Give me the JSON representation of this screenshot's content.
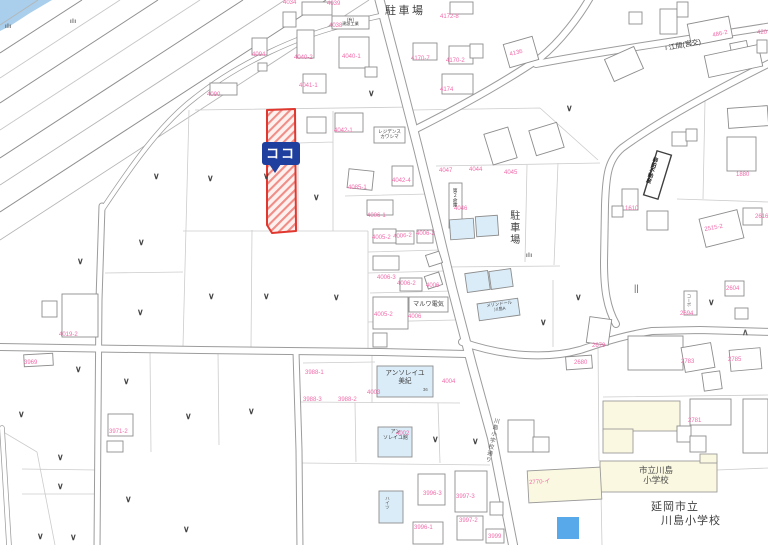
{
  "map": {
    "highlight": {
      "marker_label": "ココ",
      "parcel_color": "#e0372f",
      "marker_color": "#1e3f9e"
    },
    "place_labels": [
      {
        "name": "parking-label-top",
        "lines": [
          "駐車場"
        ],
        "x": 385,
        "y": 5,
        "size": 11,
        "ls": 2.5,
        "color": "#3d3d3d"
      },
      {
        "name": "parking-label-east",
        "lines": [
          "駐車場"
        ],
        "x": 507,
        "y": 210,
        "size": 10,
        "ls": 2,
        "vertical": true,
        "color": "#3d3d3d"
      },
      {
        "name": "maruwa-denki-label",
        "lines": [
          "マルワ電気"
        ],
        "x": 410,
        "y": 301,
        "size": 6.2,
        "w": 37,
        "center": true
      },
      {
        "name": "residence-kawashima-label",
        "lines": [
          "レジデンス",
          "カワシマ"
        ],
        "x": 375,
        "y": 129,
        "size": 4.6,
        "w": 29,
        "center": true
      },
      {
        "name": "kensetsu-kogyo-label",
        "lines": [
          "(有)",
          "建設工業"
        ],
        "x": 333,
        "y": 17.5,
        "size": 4.2,
        "w": 35,
        "center": true
      },
      {
        "name": "warehouse-sign-label",
        "lines": [
          "第２倉庫"
        ],
        "x": 451,
        "y": 188,
        "size": 4.8,
        "vertical": true
      },
      {
        "name": "yanagida-fudosan-label",
        "lines": [
          "柳田不動産"
        ],
        "x": 652,
        "y": 156,
        "size": 5.4,
        "vertical": true,
        "rot": 17,
        "bold": true,
        "color": "#222222"
      },
      {
        "name": "corpo-sign-label",
        "lines": [
          "コーポ"
        ],
        "x": 686,
        "y": 294,
        "size": 4.2,
        "vertical": true,
        "color": "#555555"
      },
      {
        "name": "maison-dor-label",
        "lines": [
          "メゾンドール",
          "川島A"
        ],
        "x": 480,
        "y": 304,
        "size": 4.3,
        "rot": -8,
        "w": 38,
        "center": true
      },
      {
        "name": "ensoleille-miki-label",
        "lines": [
          "アンソレイユ",
          "美紀"
        ],
        "x": 380,
        "y": 370,
        "size": 6.6,
        "w": 50,
        "center": true
      },
      {
        "name": "ensoleille-kan-label",
        "lines": [
          "アン",
          "ソレイユ館"
        ],
        "x": 380,
        "y": 430,
        "size": 5,
        "w": 31,
        "center": true
      },
      {
        "name": "heights-label",
        "lines": [
          "ハイツ"
        ],
        "x": 385,
        "y": 496,
        "size": 4.6,
        "vertical": true,
        "color": "#555555"
      },
      {
        "name": "school-building-label",
        "lines": [
          "市立川島",
          "小学校"
        ],
        "x": 630,
        "y": 465,
        "size": 8.5,
        "w": 52,
        "center": true,
        "color": "#4c4c4c"
      },
      {
        "name": "school-name-line1",
        "lines": [
          "延岡市立"
        ],
        "x": 651,
        "y": 501,
        "size": 11,
        "ls": 1,
        "color": "#3e3e3e"
      },
      {
        "name": "school-name-line2",
        "lines": [
          "川島小学校"
        ],
        "x": 661,
        "y": 515,
        "size": 11,
        "ls": 1,
        "color": "#3e3e3e"
      },
      {
        "name": "bus-stop-label",
        "lines": [
          "♀江間(宮交)"
        ],
        "x": 663,
        "y": 46,
        "size": 7,
        "rot": -11,
        "color": "#333333"
      },
      {
        "name": "road-name-label",
        "lines": [
          "川島小学校通り"
        ],
        "x": 493,
        "y": 417,
        "size": 5.6,
        "vertical": true,
        "rot": 12,
        "ls": 1,
        "color": "#555555"
      },
      {
        "name": "house-number-36",
        "lines": [
          "36"
        ],
        "x": 423,
        "y": 388,
        "size": 4.2,
        "color": "#555555"
      }
    ],
    "parcel_labels": [
      {
        "t": "4034",
        "x": 283,
        "y": 0
      },
      {
        "t": "4039",
        "x": 327,
        "y": 1
      },
      {
        "t": "4038",
        "x": 329,
        "y": 23
      },
      {
        "t": "4040-2",
        "x": 294,
        "y": 55
      },
      {
        "t": "4040-1",
        "x": 342,
        "y": 54
      },
      {
        "t": "4041-1",
        "x": 299,
        "y": 83
      },
      {
        "t": "4094",
        "x": 252,
        "y": 52
      },
      {
        "t": "4090",
        "x": 207,
        "y": 92
      },
      {
        "t": "4172-8",
        "x": 440,
        "y": 14
      },
      {
        "t": "4170-7",
        "x": 411,
        "y": 56
      },
      {
        "t": "4170-2",
        "x": 446,
        "y": 58
      },
      {
        "t": "4174",
        "x": 440,
        "y": 87
      },
      {
        "t": "4136",
        "x": 509,
        "y": 52,
        "r": -14
      },
      {
        "t": "486-2",
        "x": 712,
        "y": 33,
        "r": -12
      },
      {
        "t": "420",
        "x": 757,
        "y": 30
      },
      {
        "t": "4042-1",
        "x": 334,
        "y": 128
      },
      {
        "t": "4042-4",
        "x": 392,
        "y": 178
      },
      {
        "t": "4085-1",
        "x": 348,
        "y": 185
      },
      {
        "t": "4047",
        "x": 439,
        "y": 168
      },
      {
        "t": "4044",
        "x": 469,
        "y": 167
      },
      {
        "t": "4045",
        "x": 504,
        "y": 170
      },
      {
        "t": "4046",
        "x": 454,
        "y": 206
      },
      {
        "t": "4006-1",
        "x": 367,
        "y": 213
      },
      {
        "t": "4005-2",
        "x": 372,
        "y": 235
      },
      {
        "t": "4006-2",
        "x": 393,
        "y": 234,
        "r": -4
      },
      {
        "t": "4006-2",
        "x": 416,
        "y": 231
      },
      {
        "t": "4006-3",
        "x": 377,
        "y": 275
      },
      {
        "t": "4006-2",
        "x": 397,
        "y": 281
      },
      {
        "t": "4006",
        "x": 426,
        "y": 283
      },
      {
        "t": "4005-2",
        "x": 374,
        "y": 312
      },
      {
        "t": "4006",
        "x": 408,
        "y": 314
      },
      {
        "t": "1880",
        "x": 736,
        "y": 172
      },
      {
        "t": "1610",
        "x": 625,
        "y": 206
      },
      {
        "t": "2515-2",
        "x": 704,
        "y": 227,
        "r": -10
      },
      {
        "t": "2616",
        "x": 755,
        "y": 214
      },
      {
        "t": "2604",
        "x": 726,
        "y": 286
      },
      {
        "t": "2694",
        "x": 680,
        "y": 311
      },
      {
        "t": "2679",
        "x": 592,
        "y": 343
      },
      {
        "t": "2680",
        "x": 574,
        "y": 360
      },
      {
        "t": "2783",
        "x": 681,
        "y": 359
      },
      {
        "t": "2785",
        "x": 728,
        "y": 357
      },
      {
        "t": "2781",
        "x": 688,
        "y": 418
      },
      {
        "t": "2770-イ",
        "x": 529,
        "y": 480,
        "r": -3
      },
      {
        "t": "4019-2",
        "x": 59,
        "y": 332
      },
      {
        "t": "3969",
        "x": 24,
        "y": 360
      },
      {
        "t": "3971-2",
        "x": 109,
        "y": 429
      },
      {
        "t": "3988-1",
        "x": 305,
        "y": 370
      },
      {
        "t": "3988-3",
        "x": 303,
        "y": 397
      },
      {
        "t": "3988-2",
        "x": 338,
        "y": 397
      },
      {
        "t": "4002",
        "x": 396,
        "y": 431
      },
      {
        "t": "4003",
        "x": 367,
        "y": 390
      },
      {
        "t": "4004",
        "x": 442,
        "y": 379
      },
      {
        "t": "3996-3",
        "x": 423,
        "y": 491
      },
      {
        "t": "3997-3",
        "x": 456,
        "y": 494
      },
      {
        "t": "3997-2",
        "x": 459,
        "y": 518
      },
      {
        "t": "3996-1",
        "x": 414,
        "y": 525
      },
      {
        "t": "3999",
        "x": 488,
        "y": 534
      }
    ],
    "buildings": [
      [
        283,
        12,
        13,
        15
      ],
      [
        302,
        2,
        30,
        13
      ],
      [
        332,
        16,
        37,
        13
      ],
      [
        297,
        30,
        17,
        28
      ],
      [
        339,
        37,
        30,
        31
      ],
      [
        365,
        67,
        12,
        10
      ],
      [
        303,
        74,
        23,
        19
      ],
      [
        252,
        38,
        15,
        17
      ],
      [
        258,
        63,
        9,
        8
      ],
      [
        210,
        83,
        27,
        12
      ],
      [
        307,
        117,
        19,
        16
      ],
      [
        335,
        113,
        28,
        19
      ],
      [
        374,
        127,
        31,
        16
      ],
      [
        348,
        170,
        25,
        19,
        6
      ],
      [
        392,
        166,
        21,
        20
      ],
      [
        367,
        200,
        26,
        15
      ],
      [
        373,
        229,
        23,
        14
      ],
      [
        396,
        231,
        18,
        13
      ],
      [
        417,
        230,
        16,
        13
      ],
      [
        373,
        256,
        26,
        14
      ],
      [
        427,
        253,
        14,
        12,
        -18
      ],
      [
        400,
        278,
        22,
        13
      ],
      [
        426,
        274,
        15,
        13,
        -18
      ],
      [
        409,
        297,
        39,
        15
      ],
      [
        373,
        297,
        35,
        32
      ],
      [
        373,
        333,
        14,
        14
      ],
      [
        450,
        2,
        23,
        12
      ],
      [
        413,
        43,
        24,
        17
      ],
      [
        449,
        46,
        24,
        18
      ],
      [
        442,
        74,
        31,
        20
      ],
      [
        470,
        44,
        13,
        14
      ],
      [
        506,
        40,
        30,
        24,
        -16
      ],
      [
        488,
        130,
        25,
        32,
        -17
      ],
      [
        532,
        126,
        29,
        26,
        -17
      ],
      [
        608,
        52,
        32,
        24,
        -24
      ],
      [
        660,
        9,
        17,
        25
      ],
      [
        677,
        2,
        11,
        15
      ],
      [
        629,
        12,
        13,
        12
      ],
      [
        689,
        20,
        42,
        22,
        -11
      ],
      [
        731,
        42,
        17,
        15,
        -11
      ],
      [
        706,
        50,
        55,
        22,
        -12
      ],
      [
        757,
        40,
        10,
        13
      ],
      [
        449,
        183,
        13,
        45
      ],
      [
        450,
        219,
        24,
        20,
        -4,
        "b"
      ],
      [
        476,
        216,
        22,
        20,
        -4,
        "b"
      ],
      [
        466,
        272,
        23,
        19,
        -8,
        "b"
      ],
      [
        490,
        270,
        22,
        18,
        -8,
        "b"
      ],
      [
        478,
        301,
        41,
        17,
        -8,
        "b"
      ],
      [
        728,
        107,
        40,
        20,
        -4
      ],
      [
        727,
        137,
        29,
        34
      ],
      [
        650,
        152,
        15,
        46,
        17,
        "d"
      ],
      [
        672,
        132,
        15,
        14
      ],
      [
        686,
        129,
        11,
        12
      ],
      [
        622,
        189,
        16,
        21
      ],
      [
        612,
        206,
        11,
        11
      ],
      [
        647,
        211,
        21,
        19
      ],
      [
        702,
        214,
        39,
        29,
        -14
      ],
      [
        743,
        208,
        19,
        17
      ],
      [
        684,
        291,
        13,
        24
      ],
      [
        725,
        281,
        19,
        15
      ],
      [
        735,
        308,
        13,
        11
      ],
      [
        588,
        318,
        22,
        26,
        8
      ],
      [
        566,
        356,
        26,
        13,
        -4
      ],
      [
        628,
        336,
        55,
        34
      ],
      [
        683,
        345,
        30,
        25,
        -10
      ],
      [
        703,
        372,
        18,
        18,
        -8
      ],
      [
        730,
        349,
        31,
        21,
        -5
      ],
      [
        108,
        414,
        25,
        22
      ],
      [
        107,
        441,
        16,
        11
      ],
      [
        62,
        294,
        36,
        43
      ],
      [
        42,
        301,
        15,
        16
      ],
      [
        24,
        354,
        29,
        12,
        -3
      ],
      [
        508,
        420,
        26,
        32
      ],
      [
        533,
        437,
        16,
        15
      ],
      [
        377,
        366,
        56,
        31,
        0,
        "b"
      ],
      [
        378,
        427,
        34,
        30,
        0,
        "b"
      ],
      [
        379,
        491,
        24,
        32,
        0,
        "b"
      ],
      [
        418,
        474,
        27,
        31
      ],
      [
        455,
        471,
        32,
        41
      ],
      [
        457,
        516,
        26,
        24
      ],
      [
        413,
        522,
        30,
        22
      ],
      [
        486,
        529,
        18,
        14
      ],
      [
        490,
        502,
        13,
        13
      ],
      [
        603,
        401,
        77,
        30,
        0,
        "y"
      ],
      [
        603,
        429,
        30,
        24,
        0,
        "y"
      ],
      [
        600,
        461,
        117,
        31,
        0,
        "y"
      ],
      [
        700,
        454,
        17,
        9,
        0,
        "y"
      ],
      [
        528,
        469,
        73,
        32,
        -3,
        "y"
      ],
      [
        690,
        399,
        41,
        26
      ],
      [
        677,
        426,
        14,
        16
      ],
      [
        690,
        436,
        16,
        16
      ],
      [
        743,
        399,
        25,
        54
      ],
      [
        557,
        517,
        22,
        22,
        0,
        "p"
      ]
    ],
    "symbols": [
      {
        "k": "v",
        "x": 153,
        "y": 172
      },
      {
        "k": "v",
        "x": 207,
        "y": 174
      },
      {
        "k": "v",
        "x": 263,
        "y": 172
      },
      {
        "k": "v",
        "x": 313,
        "y": 193
      },
      {
        "k": "v",
        "x": 368,
        "y": 89
      },
      {
        "k": "v",
        "x": 566,
        "y": 104
      },
      {
        "k": "v",
        "x": 138,
        "y": 238
      },
      {
        "k": "v",
        "x": 77,
        "y": 257
      },
      {
        "k": "v",
        "x": 208,
        "y": 292
      },
      {
        "k": "v",
        "x": 263,
        "y": 292
      },
      {
        "k": "v",
        "x": 333,
        "y": 293
      },
      {
        "k": "v",
        "x": 137,
        "y": 308
      },
      {
        "k": "v",
        "x": 75,
        "y": 365
      },
      {
        "k": "v",
        "x": 123,
        "y": 377
      },
      {
        "k": "v",
        "x": 18,
        "y": 410
      },
      {
        "k": "v",
        "x": 185,
        "y": 412
      },
      {
        "k": "v",
        "x": 248,
        "y": 407
      },
      {
        "k": "v",
        "x": 57,
        "y": 453
      },
      {
        "k": "v",
        "x": 57,
        "y": 482
      },
      {
        "k": "v",
        "x": 125,
        "y": 495
      },
      {
        "k": "v",
        "x": 37,
        "y": 532
      },
      {
        "k": "v",
        "x": 70,
        "y": 533
      },
      {
        "k": "v",
        "x": 183,
        "y": 525
      },
      {
        "k": "v",
        "x": 432,
        "y": 435
      },
      {
        "k": "v",
        "x": 472,
        "y": 437
      },
      {
        "k": "v",
        "x": 575,
        "y": 293
      },
      {
        "k": "v",
        "x": 708,
        "y": 298
      },
      {
        "k": "v",
        "x": 540,
        "y": 318
      },
      {
        "k": "grass",
        "x": 5,
        "y": 24
      },
      {
        "k": "grass",
        "x": 70,
        "y": 19
      },
      {
        "k": "grass",
        "x": 526,
        "y": 253
      },
      {
        "k": "paddy",
        "x": 634,
        "y": 284
      },
      {
        "k": "tree",
        "x": 742,
        "y": 328
      }
    ]
  }
}
